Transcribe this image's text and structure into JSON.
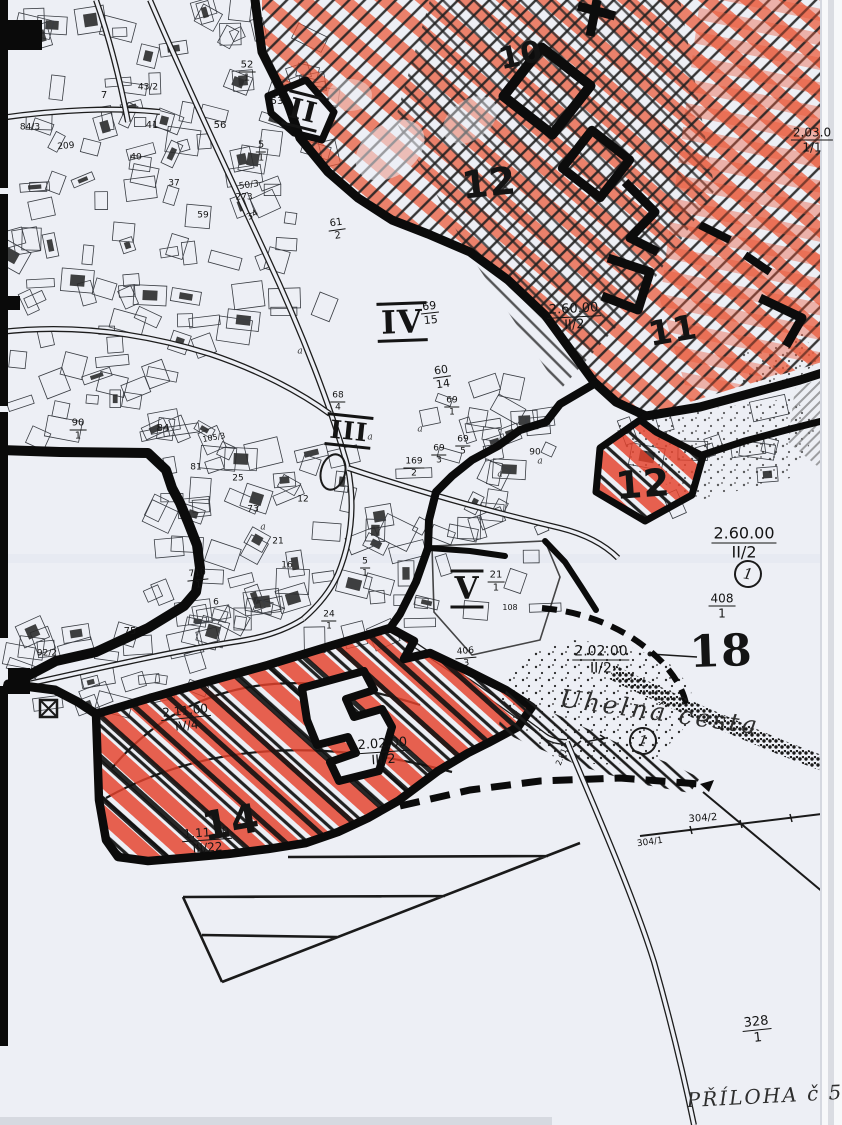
{
  "map": {
    "colors": {
      "paper": "#edeff5",
      "ink": "#141414",
      "boundary": "#0b0b0b",
      "red_hatch": "#e4402a",
      "red_light": "#ef8a74",
      "stipple": "#2a2a2a"
    },
    "zone_labels": [
      {
        "text": "II",
        "x": 303,
        "y": 111,
        "fs": 28,
        "rot": 14,
        "serif": true,
        "bars": true
      },
      {
        "text": "IV",
        "x": 402,
        "y": 322,
        "fs": 32,
        "rot": -2,
        "serif": true,
        "bars": true
      },
      {
        "text": "III",
        "x": 349,
        "y": 431,
        "fs": 25,
        "rot": 6,
        "serif": true,
        "bars": true
      },
      {
        "text": "V",
        "x": 467,
        "y": 589,
        "fs": 31,
        "rot": 0,
        "serif": true,
        "bars": true
      },
      {
        "text": "10",
        "x": 521,
        "y": 56,
        "fs": 30,
        "rot": -12,
        "serif": false,
        "bars": false
      },
      {
        "text": "12",
        "x": 489,
        "y": 183,
        "fs": 38,
        "rot": -6,
        "serif": false,
        "bars": false
      },
      {
        "text": "11",
        "x": 673,
        "y": 331,
        "fs": 34,
        "rot": -10,
        "serif": false,
        "bars": false
      },
      {
        "text": "12",
        "x": 643,
        "y": 484,
        "fs": 38,
        "rot": -4,
        "serif": false,
        "bars": false
      },
      {
        "text": "18",
        "x": 721,
        "y": 652,
        "fs": 44,
        "rot": -2,
        "serif": true,
        "bars": false
      },
      {
        "text": "14",
        "x": 231,
        "y": 823,
        "fs": 40,
        "rot": -10,
        "serif": false,
        "bars": false
      }
    ],
    "ref_labels": [
      {
        "n": "2.03.0",
        "d": "1/1",
        "x": 812,
        "y": 140,
        "fs": 12,
        "r": 0
      },
      {
        "n": "2.60.00",
        "d": "II/2",
        "x": 574,
        "y": 317,
        "fs": 13,
        "r": -3
      },
      {
        "n": "2.60.00",
        "d": "II/2",
        "x": 744,
        "y": 543,
        "fs": 16,
        "r": 0
      },
      {
        "n": "408",
        "d": "1",
        "x": 722,
        "y": 606,
        "fs": 12,
        "r": 0
      },
      {
        "n": "2.02.00",
        "d": "II/2",
        "x": 601,
        "y": 660,
        "fs": 14,
        "r": 0
      },
      {
        "n": "2.02.00",
        "d": "III/2",
        "x": 383,
        "y": 752,
        "fs": 13,
        "r": -4
      },
      {
        "n": "2.11.00",
        "d": "IV/4",
        "x": 186,
        "y": 718,
        "fs": 12,
        "r": -6
      },
      {
        "n": "1.11.10",
        "d": "III/22",
        "x": 207,
        "y": 840,
        "fs": 12,
        "r": -4
      },
      {
        "n": "328",
        "d": "1",
        "x": 757,
        "y": 1030,
        "fs": 13,
        "r": -6
      },
      {
        "n": "52",
        "d": "1",
        "x": 247,
        "y": 72,
        "fs": 10,
        "r": 0
      },
      {
        "n": "5",
        "d": "1",
        "x": 261,
        "y": 152,
        "fs": 10,
        "r": 0
      },
      {
        "n": "61",
        "d": "2",
        "x": 337,
        "y": 230,
        "fs": 10,
        "r": -8
      },
      {
        "n": "69",
        "d": "15",
        "x": 430,
        "y": 313,
        "fs": 11,
        "r": -6
      },
      {
        "n": "60",
        "d": "14",
        "x": 442,
        "y": 377,
        "fs": 11,
        "r": -8
      },
      {
        "n": "69",
        "d": "1",
        "x": 452,
        "y": 407,
        "fs": 9,
        "r": 0
      },
      {
        "n": "68",
        "d": "4",
        "x": 338,
        "y": 402,
        "fs": 9,
        "r": 0
      },
      {
        "n": "69",
        "d": "5",
        "x": 463,
        "y": 446,
        "fs": 9,
        "r": 0
      },
      {
        "n": "69",
        "d": "3",
        "x": 439,
        "y": 455,
        "fs": 9,
        "r": 0
      },
      {
        "n": "90",
        "d": "1",
        "x": 78,
        "y": 430,
        "fs": 10,
        "r": 0
      },
      {
        "n": "21",
        "d": "1",
        "x": 496,
        "y": 582,
        "fs": 10,
        "r": 0
      },
      {
        "n": "710",
        "d": "1",
        "x": 198,
        "y": 580,
        "fs": 9,
        "r": -6
      },
      {
        "n": "24",
        "d": "1",
        "x": 329,
        "y": 621,
        "fs": 9,
        "r": 0
      },
      {
        "n": "169",
        "d": "2",
        "x": 414,
        "y": 468,
        "fs": 9,
        "r": 0
      },
      {
        "n": "406",
        "d": "3",
        "x": 466,
        "y": 658,
        "fs": 9,
        "r": -5
      },
      {
        "n": "5",
        "d": "1",
        "x": 365,
        "y": 568,
        "fs": 9,
        "r": 0
      }
    ],
    "parcel_labels": [
      {
        "t": "53",
        "x": 277,
        "y": 102,
        "fs": 10,
        "r": 0
      },
      {
        "t": "50/3",
        "x": 249,
        "y": 186,
        "fs": 9,
        "r": -8
      },
      {
        "t": "273",
        "x": 244,
        "y": 198,
        "fs": 9,
        "r": 0
      },
      {
        "t": "34",
        "x": 253,
        "y": 216,
        "fs": 9,
        "r": -30
      },
      {
        "t": "7",
        "x": 104,
        "y": 96,
        "fs": 10,
        "r": 0
      },
      {
        "t": "41",
        "x": 152,
        "y": 126,
        "fs": 10,
        "r": 0
      },
      {
        "t": "56",
        "x": 220,
        "y": 126,
        "fs": 10,
        "r": 0
      },
      {
        "t": "43/2",
        "x": 148,
        "y": 88,
        "fs": 9,
        "r": 0
      },
      {
        "t": "84/3",
        "x": 30,
        "y": 128,
        "fs": 9,
        "r": 0
      },
      {
        "t": "209",
        "x": 66,
        "y": 147,
        "fs": 9,
        "r": -5
      },
      {
        "t": "40",
        "x": 136,
        "y": 158,
        "fs": 9,
        "r": 0
      },
      {
        "t": "37",
        "x": 174,
        "y": 184,
        "fs": 9,
        "r": 0
      },
      {
        "t": "59",
        "x": 203,
        "y": 216,
        "fs": 9,
        "r": 0
      },
      {
        "t": "84",
        "x": 163,
        "y": 429,
        "fs": 10,
        "r": 0
      },
      {
        "t": "81",
        "x": 196,
        "y": 468,
        "fs": 9,
        "r": 0
      },
      {
        "t": "25",
        "x": 238,
        "y": 479,
        "fs": 9,
        "r": 0
      },
      {
        "t": "73",
        "x": 253,
        "y": 510,
        "fs": 9,
        "r": 0
      },
      {
        "t": "105/3",
        "x": 214,
        "y": 438,
        "fs": 8,
        "r": -10
      },
      {
        "t": "75",
        "x": 130,
        "y": 632,
        "fs": 10,
        "r": 0
      },
      {
        "t": "92/2",
        "x": 47,
        "y": 654,
        "fs": 9,
        "r": 0
      },
      {
        "t": "12",
        "x": 303,
        "y": 500,
        "fs": 9,
        "r": 0
      },
      {
        "t": "21",
        "x": 278,
        "y": 542,
        "fs": 9,
        "r": 0
      },
      {
        "t": "16",
        "x": 287,
        "y": 566,
        "fs": 9,
        "r": 0
      },
      {
        "t": "6",
        "x": 216,
        "y": 603,
        "fs": 9,
        "r": 0
      },
      {
        "t": "90",
        "x": 535,
        "y": 453,
        "fs": 9,
        "r": 0
      },
      {
        "t": "108",
        "x": 510,
        "y": 608,
        "fs": 8,
        "r": 0
      },
      {
        "t": "304/2",
        "x": 703,
        "y": 819,
        "fs": 10,
        "r": -4
      },
      {
        "t": "304/1",
        "x": 650,
        "y": 843,
        "fs": 9,
        "r": -8
      },
      {
        "t": "2.91",
        "x": 562,
        "y": 757,
        "fs": 8,
        "r": -68
      }
    ],
    "letter_marks": [
      {
        "t": "a",
        "x": 300,
        "y": 352
      },
      {
        "t": "a",
        "x": 370,
        "y": 438
      },
      {
        "t": "a",
        "x": 420,
        "y": 430
      },
      {
        "t": "a",
        "x": 500,
        "y": 475
      },
      {
        "t": "a",
        "x": 540,
        "y": 462
      },
      {
        "t": "a",
        "x": 263,
        "y": 528
      }
    ],
    "handwritten": [
      {
        "id": "road-name",
        "text": "Uhelná cesta"
      },
      {
        "id": "attachment-note",
        "text": "PŘÍLOHA č 5"
      }
    ],
    "circled_markers": [
      {
        "text": "1",
        "x": 748,
        "y": 574
      },
      {
        "text": "1",
        "x": 643,
        "y": 741
      }
    ]
  }
}
